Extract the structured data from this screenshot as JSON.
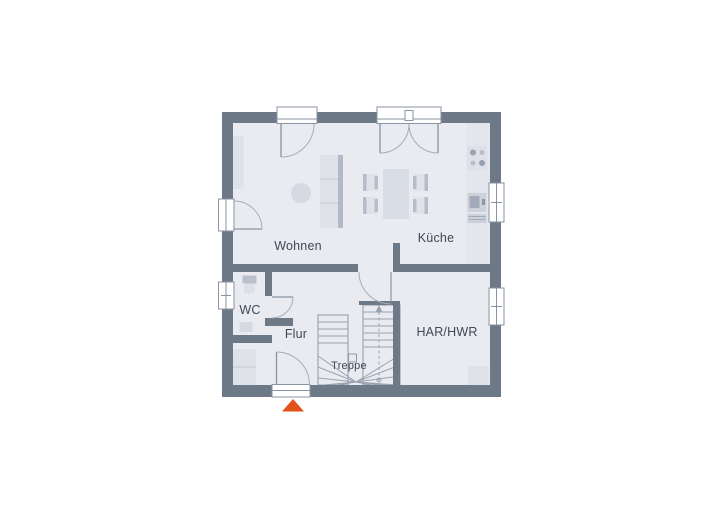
{
  "floorplan": {
    "title": "Erdgeschoss Grundriss",
    "rooms": {
      "wohnen": {
        "label": "Wohnen"
      },
      "kueche": {
        "label": "Küche"
      },
      "wc": {
        "label": "WC"
      },
      "flur": {
        "label": "Flur"
      },
      "treppe": {
        "label": "Treppe"
      },
      "har_hwr": {
        "label": "HAR/HWR"
      }
    },
    "colors": {
      "wall": "#6e7988",
      "floor": "#e9ebf1",
      "furniture": "#dfe2e9",
      "line": "#9aa2b0",
      "label": "#3e4856",
      "entrance_marker": "#e2521a"
    },
    "fixtures": [
      "sofa",
      "coffee-table",
      "shelving-unit",
      "dining-table",
      "dining-chairs",
      "kitchen-counter",
      "stove",
      "kitchen-sink",
      "dishwasher",
      "toilet",
      "wash-basin",
      "wardrobe",
      "stairs",
      "utility-appliance"
    ],
    "entrance_marker": "triangle-up"
  }
}
